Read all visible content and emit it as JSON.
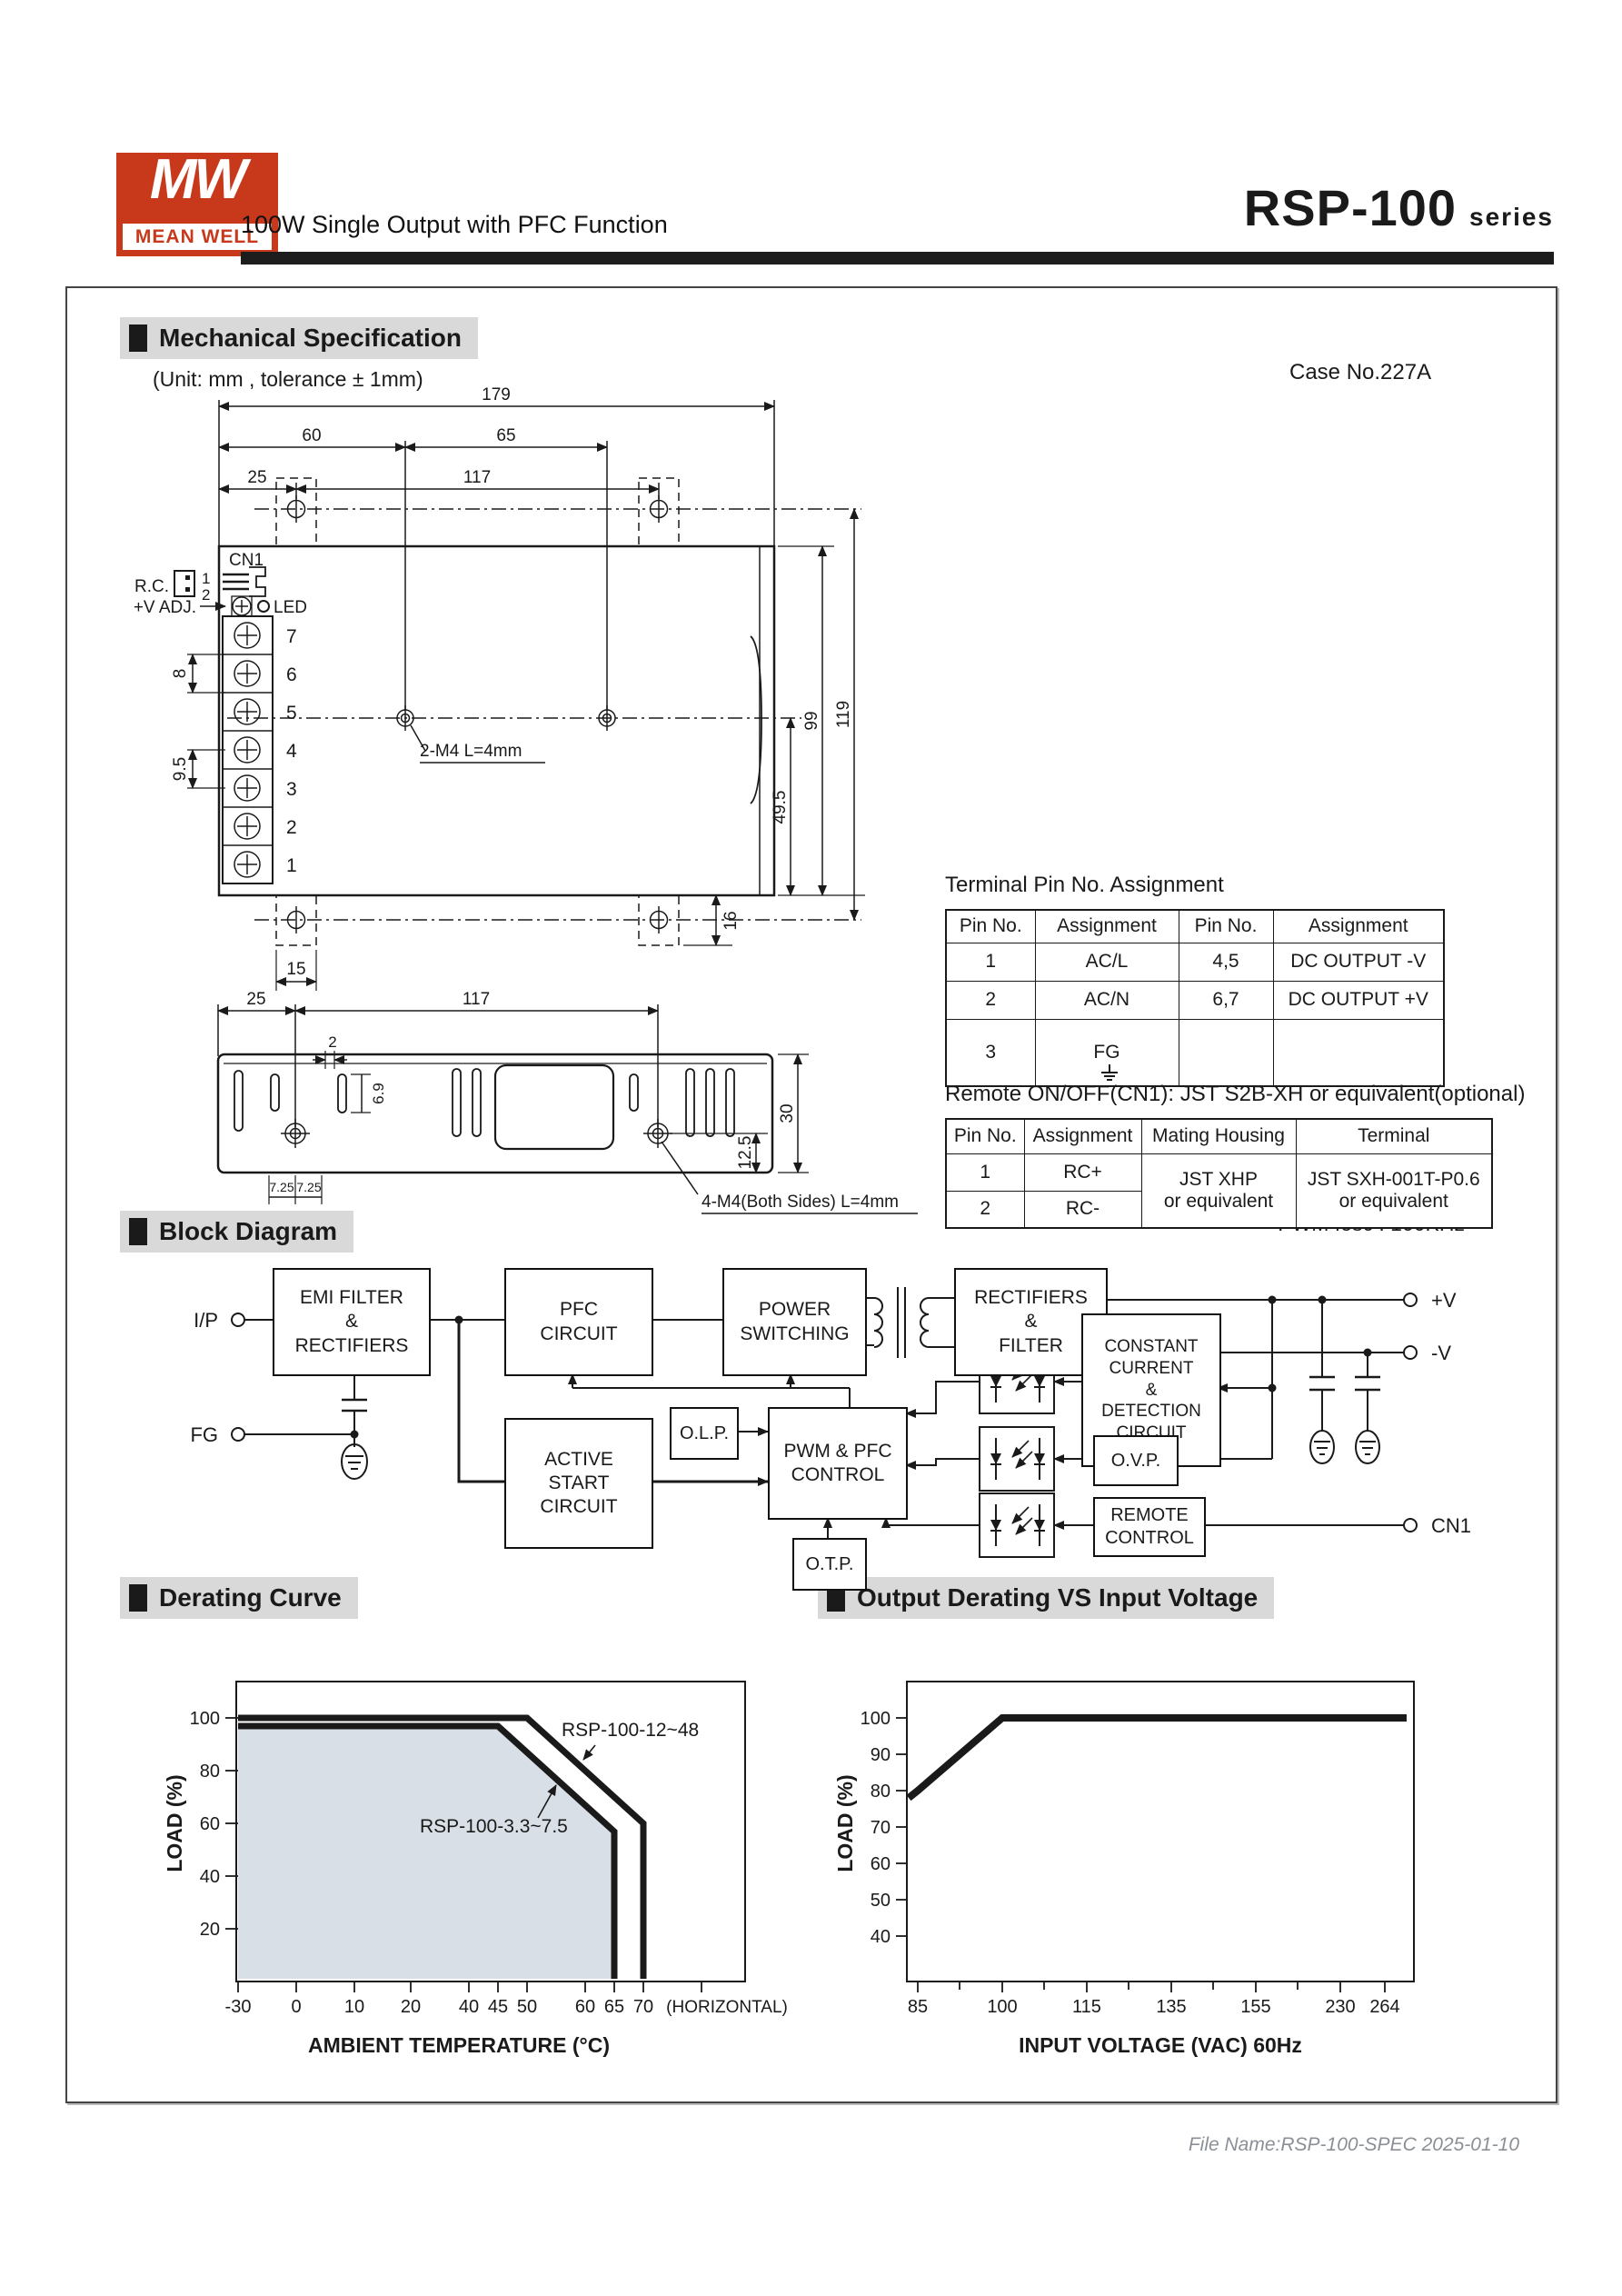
{
  "header": {
    "logo_mw": "MW",
    "logo_brand": "MEAN WELL",
    "subtitle": "100W Single Output with PFC Function",
    "series_name": "RSP-100",
    "series_suffix": "series"
  },
  "sections": {
    "mechanical": "Mechanical Specification",
    "block": "Block Diagram",
    "derating": "Derating Curve",
    "output_derating": "Output Derating VS Input Voltage"
  },
  "mechanical": {
    "unit_note": "(Unit: mm , tolerance ± 1mm)",
    "case_no": "Case No.227A",
    "top": {
      "d179": "179",
      "d60": "60",
      "d65": "65",
      "d25": "25",
      "d117": "117",
      "d8": "8",
      "d9_5": "9.5",
      "d99": "99",
      "d119": "119",
      "d49_5": "49.5",
      "d16": "16",
      "d15": "15",
      "cn1": "CN1",
      "rc": "R.C.",
      "pin1": "1",
      "pin2": "2",
      "v_adj": "+V ADJ.",
      "led": "LED",
      "m4": "2-M4 L=4mm",
      "terminals": [
        "7",
        "6",
        "5",
        "4",
        "3",
        "2",
        "1"
      ]
    },
    "side": {
      "d25": "25",
      "d117": "117",
      "d2": "2",
      "d6_9": "6.9",
      "d30": "30",
      "d12_5": "12.5",
      "d7_25a": "7.25",
      "d7_25b": "7.25",
      "m4": "4-M4(Both Sides) L=4mm"
    }
  },
  "tables": {
    "terminal": {
      "title": "Terminal Pin No.  Assignment",
      "headers": [
        "Pin No.",
        "Assignment",
        "Pin No.",
        "Assignment"
      ],
      "rows": [
        [
          "1",
          "AC/L",
          "4,5",
          "DC OUTPUT -V"
        ],
        [
          "2",
          "AC/N",
          "6,7",
          "DC OUTPUT +V"
        ],
        [
          "3",
          "FG",
          "",
          ""
        ]
      ]
    },
    "remote": {
      "title": "Remote ON/OFF(CN1): JST S2B-XH or equivalent(optional)",
      "headers": [
        "Pin No.",
        "Assignment",
        "Mating Housing",
        "Terminal"
      ],
      "rows": [
        [
          "1",
          "RC+"
        ],
        [
          "2",
          "RC-"
        ]
      ],
      "mating_housing": "JST XHP\nor equivalent",
      "terminal": "JST SXH-001T-P0.6\nor equivalent"
    }
  },
  "block_diagram": {
    "notes": {
      "pfc": "PFC fosc : 100KHz",
      "pwm": "PWM fosc : 100KHz"
    },
    "boxes": {
      "emi": "EMI FILTER\n&\nRECTIFIERS",
      "pfc": "PFC\nCIRCUIT",
      "power": "POWER\nSWITCHING",
      "rectifiers": "RECTIFIERS\n&\nFILTER",
      "active": "ACTIVE\nSTART\nCIRCUIT",
      "olp": "O.L.P.",
      "pwm": "PWM & PFC\nCONTROL",
      "otp": "O.T.P.",
      "cc": "CONSTANT\nCURRENT\n&\nDETECTION\nCIRCUIT",
      "ovp": "O.V.P.",
      "remote": "REMOTE\nCONTROL"
    },
    "terminals": {
      "ip": "I/P",
      "fg": "FG",
      "vplus": "+V",
      "vminus": "-V",
      "cn1": "CN1"
    }
  },
  "chart_data": [
    {
      "type": "line",
      "title": "Derating Curve",
      "xlabel": "AMBIENT TEMPERATURE (°C)",
      "ylabel": "LOAD (%)",
      "xticklabels": [
        "-30",
        "0",
        "10",
        "20",
        "40",
        "45",
        "50",
        "60",
        "65",
        "70"
      ],
      "x_end_label": "(HORIZONTAL)",
      "yticks": [
        20,
        40,
        60,
        80,
        100
      ],
      "ylim": [
        0,
        110
      ],
      "grid": false,
      "series": [
        {
          "name": "RSP-100-12~48",
          "points": [
            [
              -30,
              100
            ],
            [
              50,
              100
            ],
            [
              70,
              60
            ],
            [
              70,
              0
            ]
          ]
        },
        {
          "name": "RSP-100-3.3~7.5",
          "points": [
            [
              -30,
              100
            ],
            [
              45,
              100
            ],
            [
              65,
              60
            ],
            [
              65,
              0
            ]
          ],
          "area_fill": "#d8dfe6"
        }
      ]
    },
    {
      "type": "line",
      "title": "Output Derating VS Input Voltage",
      "xlabel": "INPUT VOLTAGE (VAC) 60Hz",
      "ylabel": "LOAD (%)",
      "xticklabels": [
        "85",
        "100",
        "115",
        "135",
        "155",
        "230",
        "264"
      ],
      "yticks": [
        40,
        50,
        60,
        70,
        80,
        90,
        100
      ],
      "ylim": [
        25,
        105
      ],
      "grid": false,
      "series": [
        {
          "name": "load",
          "points": [
            [
              85,
              80
            ],
            [
              100,
              100
            ],
            [
              264,
              100
            ]
          ]
        }
      ]
    }
  ],
  "footer": {
    "file_info": "File Name:RSP-100-SPEC  2025-01-10"
  }
}
